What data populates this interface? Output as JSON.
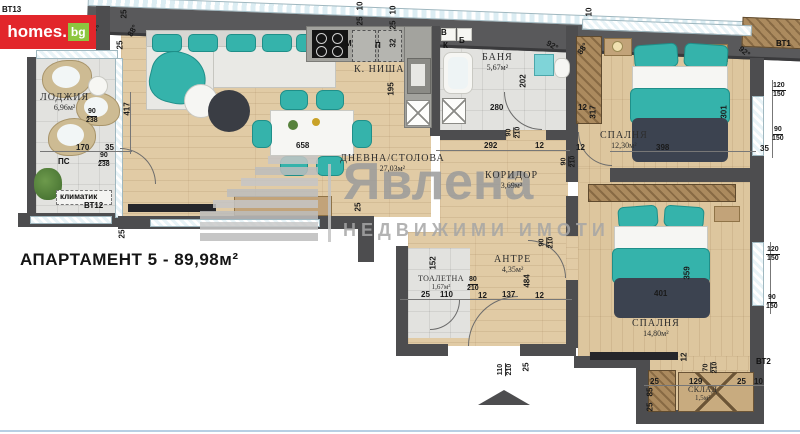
{
  "title": "АПАРТАМЕНТ 5 - 89,98м²",
  "logo": {
    "brand_main": "homes",
    "brand_dot": ".",
    "brand_tld": "bg"
  },
  "watermark": {
    "brand": "Явлена",
    "tagline": "НЕДВИЖИМИ ИМОТИ"
  },
  "room_labels": [
    {
      "name": "ЛОДЖИЯ",
      "area": "6,96м²",
      "x": 40,
      "y": 92
    },
    {
      "name": "К. НИША",
      "area": "",
      "x": 354,
      "y": 64
    },
    {
      "name": "ДНЕВНА/СТОЛОВА",
      "area": "27,03м²",
      "x": 340,
      "y": 153
    },
    {
      "name": "БАНЯ",
      "area": "5,67м²",
      "x": 482,
      "y": 52
    },
    {
      "name": "СПАЛНЯ",
      "area": "12,30м²",
      "x": 600,
      "y": 130
    },
    {
      "name": "КОРИДОР",
      "area": "3,69м²",
      "x": 485,
      "y": 170
    },
    {
      "name": "АНТРЕ",
      "area": "4,35м²",
      "x": 494,
      "y": 254
    },
    {
      "name": "ТОАЛЕТНА",
      "area": "1,67м²",
      "x": 418,
      "y": 274,
      "cls": "sm"
    },
    {
      "name": "СПАЛНЯ",
      "area": "14,80м²",
      "x": 632,
      "y": 318
    },
    {
      "name": "СКЛАД",
      "area": "1,5м²",
      "x": 688,
      "y": 385,
      "cls": "sm"
    }
  ],
  "plan_labels": [
    {
      "text": "ВТ13",
      "x": 2,
      "y": 6,
      "cls": "tag"
    },
    {
      "text": "25",
      "x": 120,
      "y": 10,
      "rot": -90
    },
    {
      "text": "98°",
      "x": 88,
      "y": 26,
      "rot": -20
    },
    {
      "text": "88°",
      "x": 127,
      "y": 27,
      "rot": -60
    },
    {
      "text": "25",
      "x": 116,
      "y": 41,
      "rot": -90
    },
    {
      "text": "90|238",
      "x": 86,
      "y": 108,
      "cls": "frac"
    },
    {
      "text": "417",
      "x": 121,
      "y": 105,
      "rot": -90
    },
    {
      "text": "170",
      "x": 76,
      "y": 144
    },
    {
      "text": "35",
      "x": 105,
      "y": 144
    },
    {
      "text": "90|238",
      "x": 98,
      "y": 152,
      "cls": "frac"
    },
    {
      "text": "ПС",
      "x": 58,
      "y": 158,
      "cls": "tag"
    },
    {
      "text": "климатик",
      "x": 60,
      "y": 193,
      "cls": "tag"
    },
    {
      "text": "ВТ12",
      "x": 84,
      "y": 202,
      "cls": "tag"
    },
    {
      "text": "25",
      "x": 118,
      "y": 230,
      "rot": -90
    },
    {
      "text": "10",
      "x": 356,
      "y": 2,
      "rot": -90
    },
    {
      "text": "25",
      "x": 356,
      "y": 17,
      "rot": -90
    },
    {
      "text": "10",
      "x": 389,
      "y": 6,
      "rot": -90
    },
    {
      "text": "25",
      "x": 389,
      "y": 21,
      "rot": -90
    },
    {
      "text": "32",
      "x": 389,
      "y": 39,
      "rot": -90
    },
    {
      "text": "М",
      "x": 345,
      "y": 40,
      "cls": "tag"
    },
    {
      "text": "П",
      "x": 375,
      "y": 42,
      "cls": "tag"
    },
    {
      "text": "195",
      "x": 385,
      "y": 85,
      "rot": -90
    },
    {
      "text": "658",
      "x": 296,
      "y": 142
    },
    {
      "text": "25",
      "x": 354,
      "y": 203,
      "rot": -90
    },
    {
      "text": "В",
      "x": 441,
      "y": 29,
      "cls": "tag"
    },
    {
      "text": "К",
      "x": 443,
      "y": 42,
      "cls": "tag"
    },
    {
      "text": "Б",
      "x": 459,
      "y": 37,
      "cls": "tag"
    },
    {
      "text": "202",
      "x": 517,
      "y": 77,
      "rot": -90
    },
    {
      "text": "280",
      "x": 490,
      "y": 104
    },
    {
      "text": "92°",
      "x": 546,
      "y": 42,
      "rot": 30
    },
    {
      "text": "90|210",
      "x": 508,
      "y": 124,
      "cls": "frac",
      "rot": -90
    },
    {
      "text": "10",
      "x": 585,
      "y": 8,
      "rot": -90
    },
    {
      "text": "88°",
      "x": 577,
      "y": 45,
      "rot": -55
    },
    {
      "text": "92°",
      "x": 738,
      "y": 48,
      "rot": 40
    },
    {
      "text": "ВТ1",
      "x": 776,
      "y": 40,
      "cls": "tag"
    },
    {
      "text": "120|150",
      "x": 772,
      "y": 82,
      "cls": "frac"
    },
    {
      "text": "90|150",
      "x": 772,
      "y": 126,
      "cls": "frac"
    },
    {
      "text": "35",
      "x": 760,
      "y": 145
    },
    {
      "text": "398",
      "x": 656,
      "y": 144
    },
    {
      "text": "301",
      "x": 718,
      "y": 108,
      "rot": -90
    },
    {
      "text": "12",
      "x": 576,
      "y": 144
    },
    {
      "text": "12",
      "x": 578,
      "y": 104
    },
    {
      "text": "317",
      "x": 587,
      "y": 108,
      "rot": -90
    },
    {
      "text": "90|210",
      "x": 563,
      "y": 153,
      "cls": "frac",
      "rot": -90
    },
    {
      "text": "292",
      "x": 484,
      "y": 142
    },
    {
      "text": "12",
      "x": 535,
      "y": 142
    },
    {
      "text": "90|210",
      "x": 541,
      "y": 234,
      "cls": "frac",
      "rot": -90
    },
    {
      "text": "484",
      "x": 521,
      "y": 277,
      "rot": -90
    },
    {
      "text": "152",
      "x": 427,
      "y": 259,
      "rot": -90
    },
    {
      "text": "80|210",
      "x": 467,
      "y": 276,
      "cls": "frac"
    },
    {
      "text": "25",
      "x": 421,
      "y": 291
    },
    {
      "text": "110",
      "x": 440,
      "y": 291
    },
    {
      "text": "12",
      "x": 478,
      "y": 292
    },
    {
      "text": "137",
      "x": 502,
      "y": 291
    },
    {
      "text": "12",
      "x": 535,
      "y": 292
    },
    {
      "text": "110|210",
      "x": 499,
      "y": 361,
      "cls": "frac",
      "rot": -90
    },
    {
      "text": "25",
      "x": 522,
      "y": 363,
      "rot": -90
    },
    {
      "text": "401",
      "x": 654,
      "y": 290
    },
    {
      "text": "359",
      "x": 681,
      "y": 269,
      "rot": -90
    },
    {
      "text": "120|150",
      "x": 766,
      "y": 246,
      "cls": "frac"
    },
    {
      "text": "90|150",
      "x": 766,
      "y": 294,
      "cls": "frac"
    },
    {
      "text": "ВТ2",
      "x": 756,
      "y": 358,
      "cls": "tag"
    },
    {
      "text": "12",
      "x": 680,
      "y": 353,
      "rot": -90
    },
    {
      "text": "70|210",
      "x": 705,
      "y": 359,
      "cls": "frac",
      "rot": -90
    },
    {
      "text": "25",
      "x": 650,
      "y": 378
    },
    {
      "text": "129",
      "x": 689,
      "y": 378
    },
    {
      "text": "25",
      "x": 737,
      "y": 378
    },
    {
      "text": "10",
      "x": 754,
      "y": 378
    },
    {
      "text": "85",
      "x": 646,
      "y": 388,
      "rot": -90
    },
    {
      "text": "25",
      "x": 646,
      "y": 403,
      "rot": -90
    }
  ]
}
